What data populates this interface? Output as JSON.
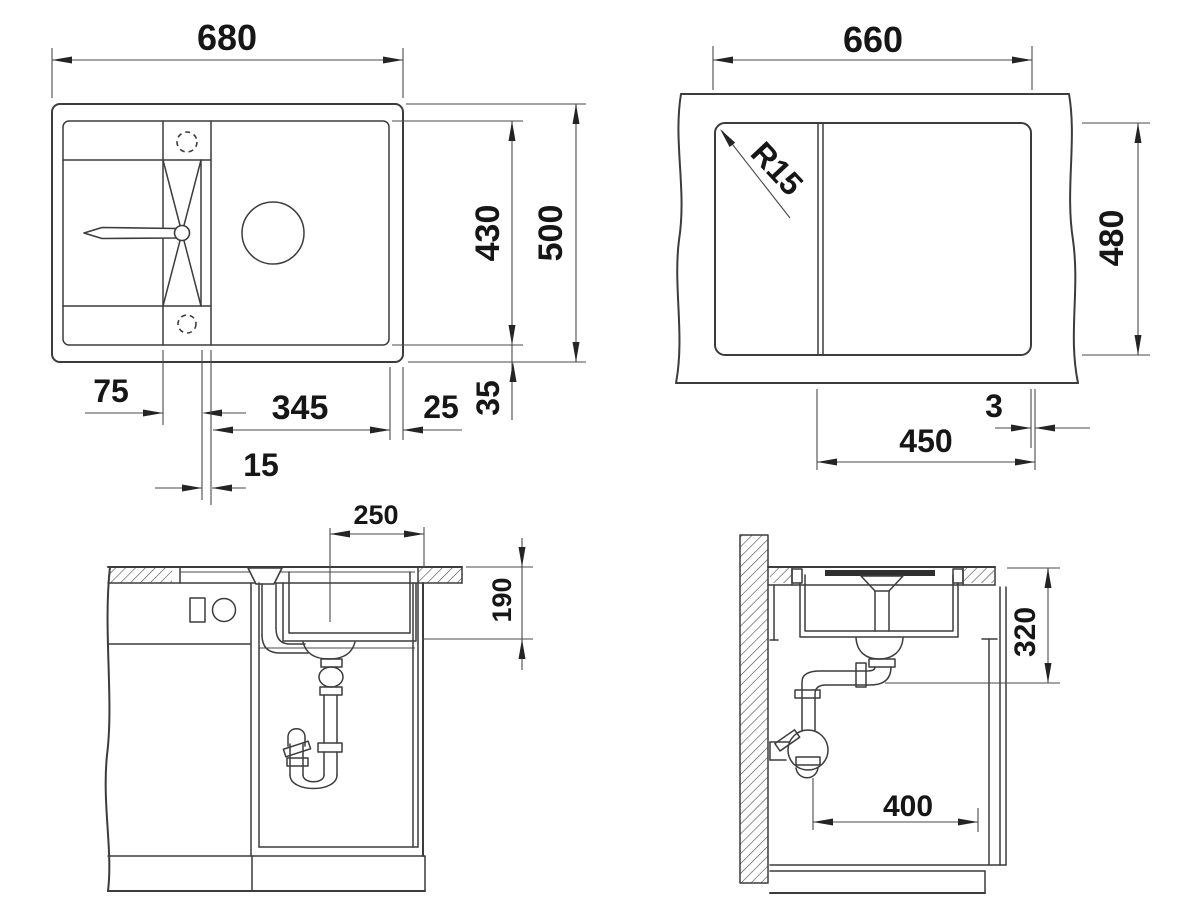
{
  "page": {
    "background": "#ffffff",
    "line_color": "#3c3c3c",
    "text_color": "#161616"
  },
  "drawing": {
    "type": "technical-dimension-drawing",
    "subject": "inset kitchen sink with drainboard - installation dimensions, four views",
    "views": {
      "top_view": {
        "name": "sink plan view",
        "dims": {
          "overall_width": "680",
          "overall_depth": "500",
          "inner_depth": "430",
          "ledge_width": "75",
          "bowl_width": "345",
          "rim_right": "25",
          "rim_bottom": "35",
          "divider_width": "15"
        }
      },
      "cutout_view": {
        "name": "worktop cutout view",
        "dims": {
          "cutout_width": "660",
          "cutout_depth": "480",
          "corner_radius": "R15",
          "bowl_zone_width": "450",
          "edge_offset": "3"
        }
      },
      "front_section": {
        "name": "front section through cabinet",
        "dims": {
          "drain_offset": "250",
          "bowl_depth": "190"
        }
      },
      "side_section": {
        "name": "side section at wall",
        "dims": {
          "outlet_height": "320",
          "wall_clearance": "400"
        }
      }
    }
  }
}
